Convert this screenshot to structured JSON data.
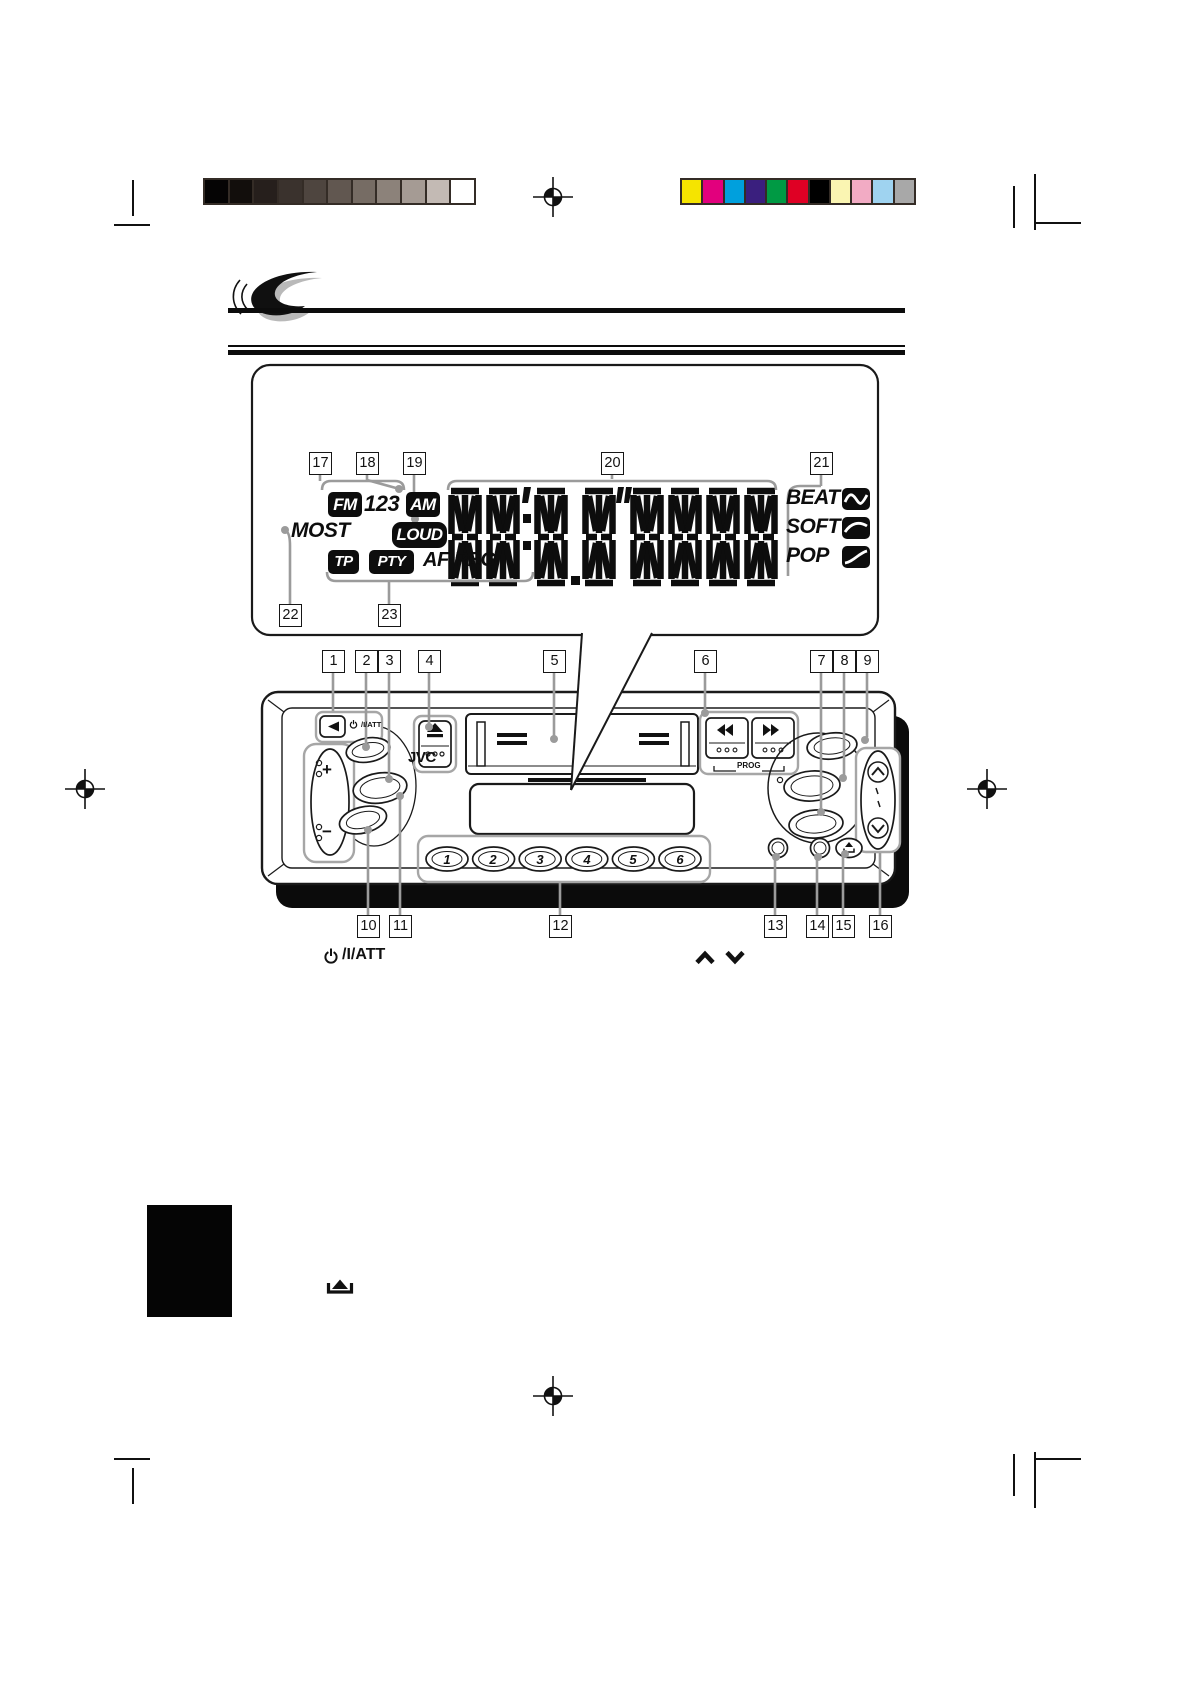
{
  "calibration": {
    "grayscale_swatches": [
      "#050404",
      "#120e0c",
      "#261f1c",
      "#3a322d",
      "#4e453f",
      "#615750",
      "#766c64",
      "#8c827a",
      "#a59b94",
      "#c3bab4",
      "#ffffff"
    ],
    "color_swatches": [
      "#f5e400",
      "#e2007d",
      "#00a0dd",
      "#3a1f7e",
      "#009a44",
      "#df0024",
      "#000000",
      "#faf5b2",
      "#f2abc4",
      "#9fd3f0",
      "#a8a8a8"
    ]
  },
  "display_diagram": {
    "callouts": {
      "c17": "17",
      "c18": "18",
      "c19": "19",
      "c20": "20",
      "c21": "21",
      "c22": "22",
      "c23": "23"
    },
    "band_indicator": "FM",
    "preset_number": "123",
    "am_indicator": "AM",
    "most_indicator": "MOST",
    "loud_indicator": "LOUD",
    "tp_indicator": "TP",
    "pty_indicator": "PTY",
    "af_reg_indicator": "AF REG",
    "sound_modes": {
      "beat": "BEAT",
      "soft": "SOFT",
      "pop": "POP"
    },
    "segment_digit_count": "8"
  },
  "panel": {
    "callouts": {
      "c1": "1",
      "c2": "2",
      "c3": "3",
      "c4": "4",
      "c5": "5",
      "c6": "6",
      "c7": "7",
      "c8": "8",
      "c9": "9",
      "c10": "10",
      "c11": "11",
      "c12": "12",
      "c13": "13",
      "c14": "14",
      "c15": "15",
      "c16": "16"
    },
    "power_button_label": "/I/ATT",
    "brand": "JVC",
    "prog_label": "PROG",
    "volume_plus": "+",
    "volume_minus": "−",
    "preset_buttons": [
      "1",
      "2",
      "3",
      "4",
      "5",
      "6"
    ]
  },
  "footer": {
    "power_att_label": "/I/ATT"
  },
  "colors": {
    "ink": "#111111",
    "leader_gray": "#9b9b9b",
    "frame_gray": "#a6a6a6"
  }
}
